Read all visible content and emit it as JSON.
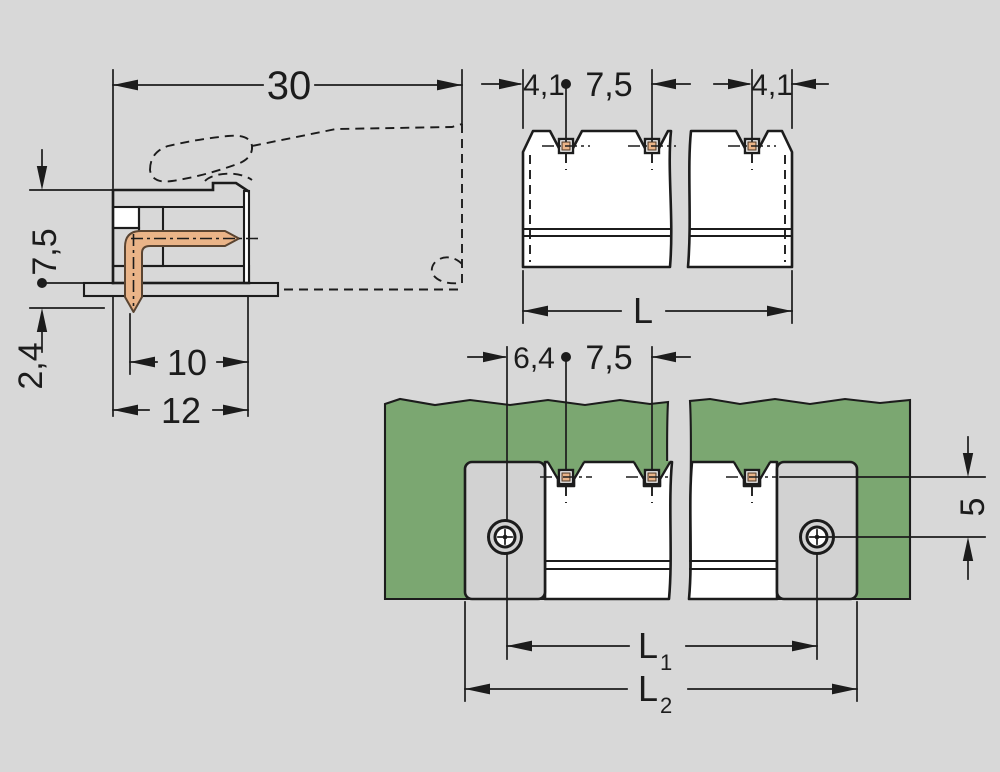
{
  "side_view": {
    "dim_width_total": "30",
    "dim_height_above_board": "7,5",
    "dim_pin_protrusion": "2,4",
    "dim_depth_housing": "10",
    "dim_depth_total": "12"
  },
  "front_view": {
    "dim_left_edge_to_pin": "4,1",
    "dim_pin_pitch": "7,5",
    "dim_pin_to_right_edge": "4,1",
    "dim_length_label": "L"
  },
  "mounted_view": {
    "dim_screw_to_pin": "6,4",
    "dim_pin_pitch": "7,5",
    "dim_pin_to_screw_vertical": "5",
    "dim_l1_label": "L",
    "dim_l1_subscript": "1",
    "dim_l2_label": "L",
    "dim_l2_subscript": "2"
  },
  "colors": {
    "background": "#d8d8d8",
    "line": "#1c1c1c",
    "board_green": "#7ba771",
    "board_hatch": "#24402a",
    "copper": "#eab488",
    "copper_outline": "#5a4431",
    "flange_gray": "#d2d2d2"
  }
}
